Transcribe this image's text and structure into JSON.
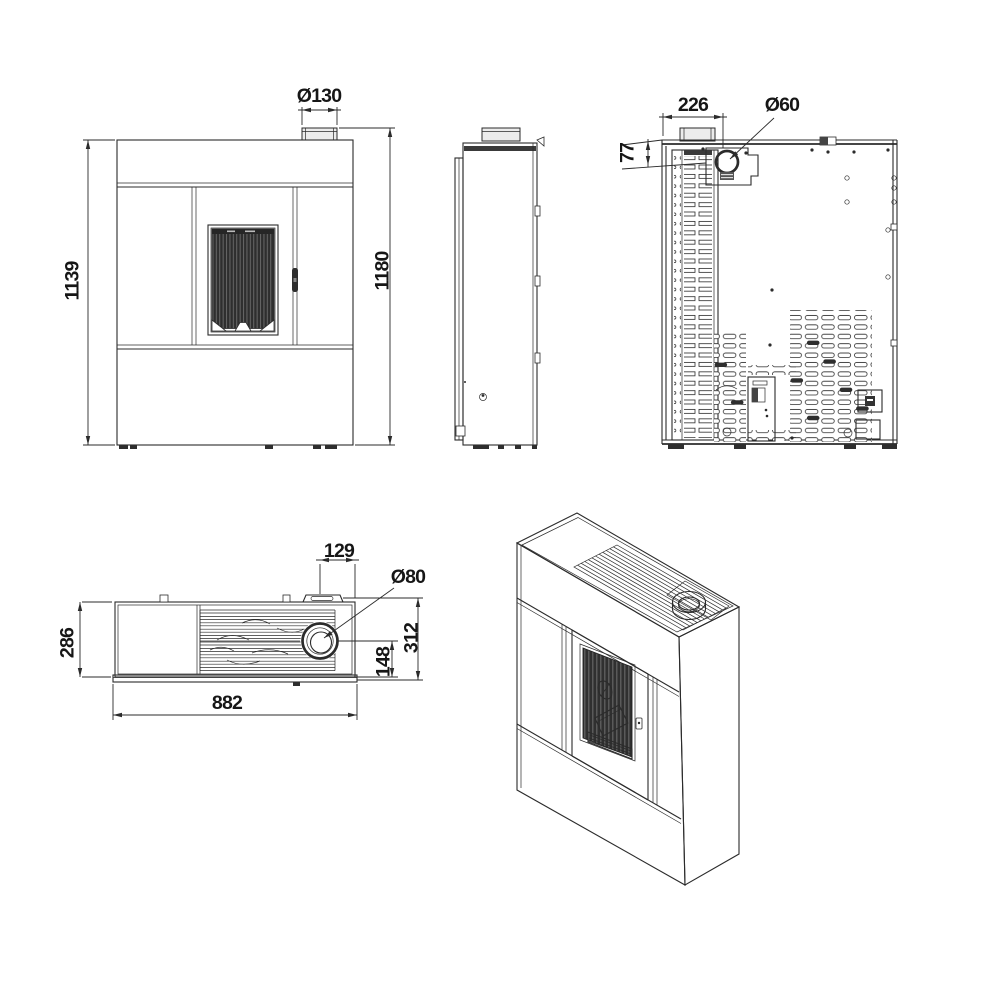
{
  "colors": {
    "line": "#2b2b2b",
    "background": "#ffffff",
    "dark_fill": "#2e2e2e"
  },
  "views": {
    "front": {
      "label": "front-view",
      "dims": {
        "flue_diameter": "Ø130",
        "body_height": "1139",
        "total_height": "1180"
      }
    },
    "side": {
      "label": "side-view"
    },
    "rear": {
      "label": "rear-view",
      "dims": {
        "exhaust_offset_x": "226",
        "exhaust_diameter": "Ø60",
        "exhaust_offset_top": "77"
      }
    },
    "top": {
      "label": "top-view",
      "dims": {
        "exhaust_offset_right": "129",
        "exhaust_diameter": "Ø80",
        "depth": "286",
        "exhaust_from_base": "148",
        "total_depth": "312",
        "width": "882"
      }
    },
    "isometric": {
      "label": "isometric-view"
    }
  }
}
